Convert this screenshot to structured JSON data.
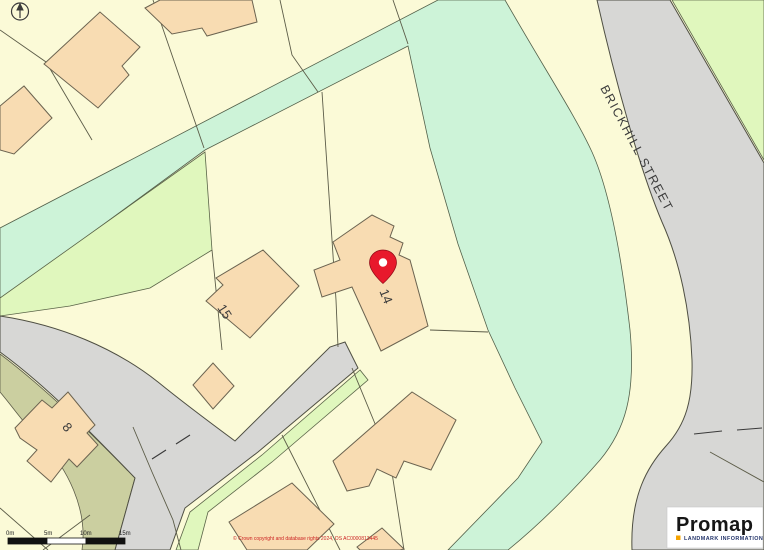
{
  "map": {
    "street_label": "BRICKHILL STREET",
    "plots": {
      "p14": "14",
      "p15": "15",
      "p8": "8"
    },
    "colors": {
      "parcel_yellow": "#fbfad7",
      "green_mint": "#cdf3d8",
      "green_light": "#e0f7bd",
      "hedge_olive": "#cbcfa0",
      "road_gray": "#d7d7d5",
      "building_peach": "#f8dcb2",
      "pin_red": "#e8192c"
    },
    "icons": {
      "pin": "location-pin",
      "north": "north-arrow"
    }
  },
  "scale_bar": {
    "labels": [
      "0m",
      "5m",
      "10m",
      "15m"
    ]
  },
  "attribution": {
    "text": "© Crown copyright and database rights 2024, OS AC0000813445"
  },
  "logo": {
    "brand": "Promap",
    "tagline": "LANDMARK INFORMATION"
  }
}
